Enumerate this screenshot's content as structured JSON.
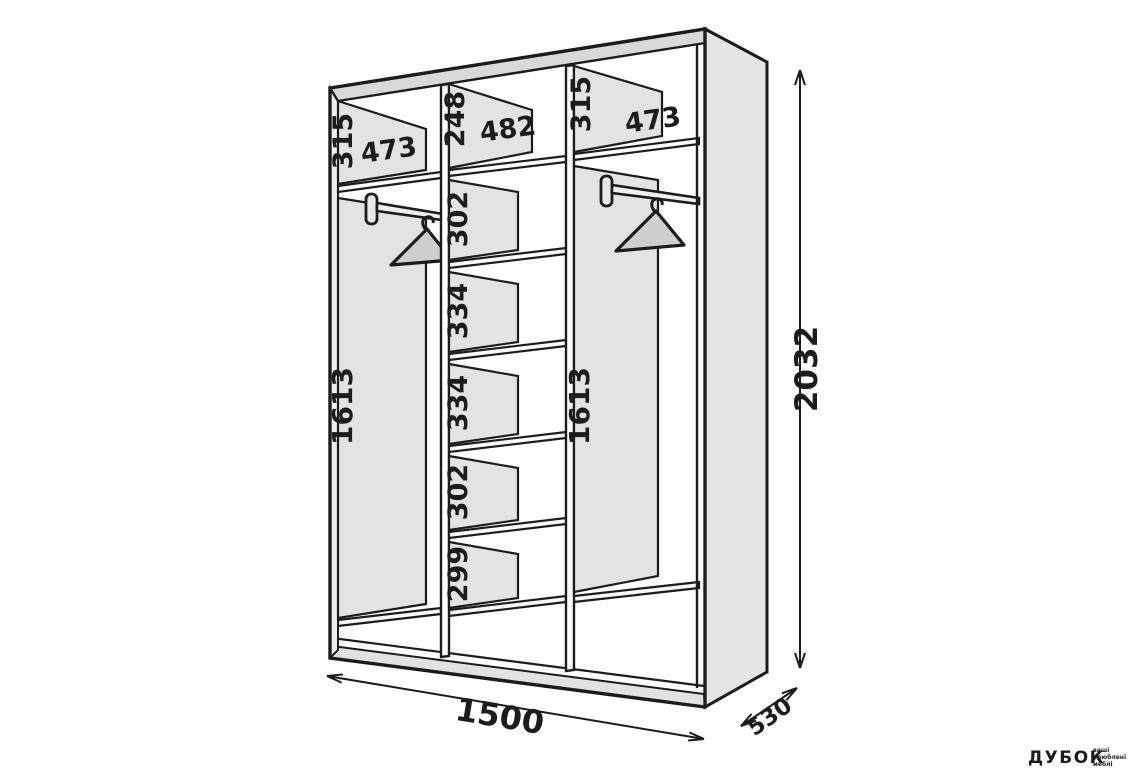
{
  "diagram": {
    "title": "wardrobe interior dimensions drawing",
    "overall": {
      "height": "2032",
      "width": "1500",
      "depth": "530"
    },
    "sections": {
      "left": {
        "top_compartment_height": "315",
        "width": "473",
        "hanging_height": "1613"
      },
      "middle": {
        "top_compartment_height": "248",
        "width": "482",
        "compartments": [
          "302",
          "334",
          "334",
          "302",
          "299"
        ]
      },
      "right": {
        "top_compartment_height": "315",
        "width": "473",
        "hanging_height": "1613"
      }
    },
    "colors": {
      "line": "#1c1c1c",
      "panel_fill": "#e3e3e3",
      "watermark_green": "#9debaa"
    }
  },
  "watermark": {
    "brand": "ДУБОК",
    "tagline_lines": [
      "ваші",
      "улюблені",
      "меблі"
    ]
  }
}
